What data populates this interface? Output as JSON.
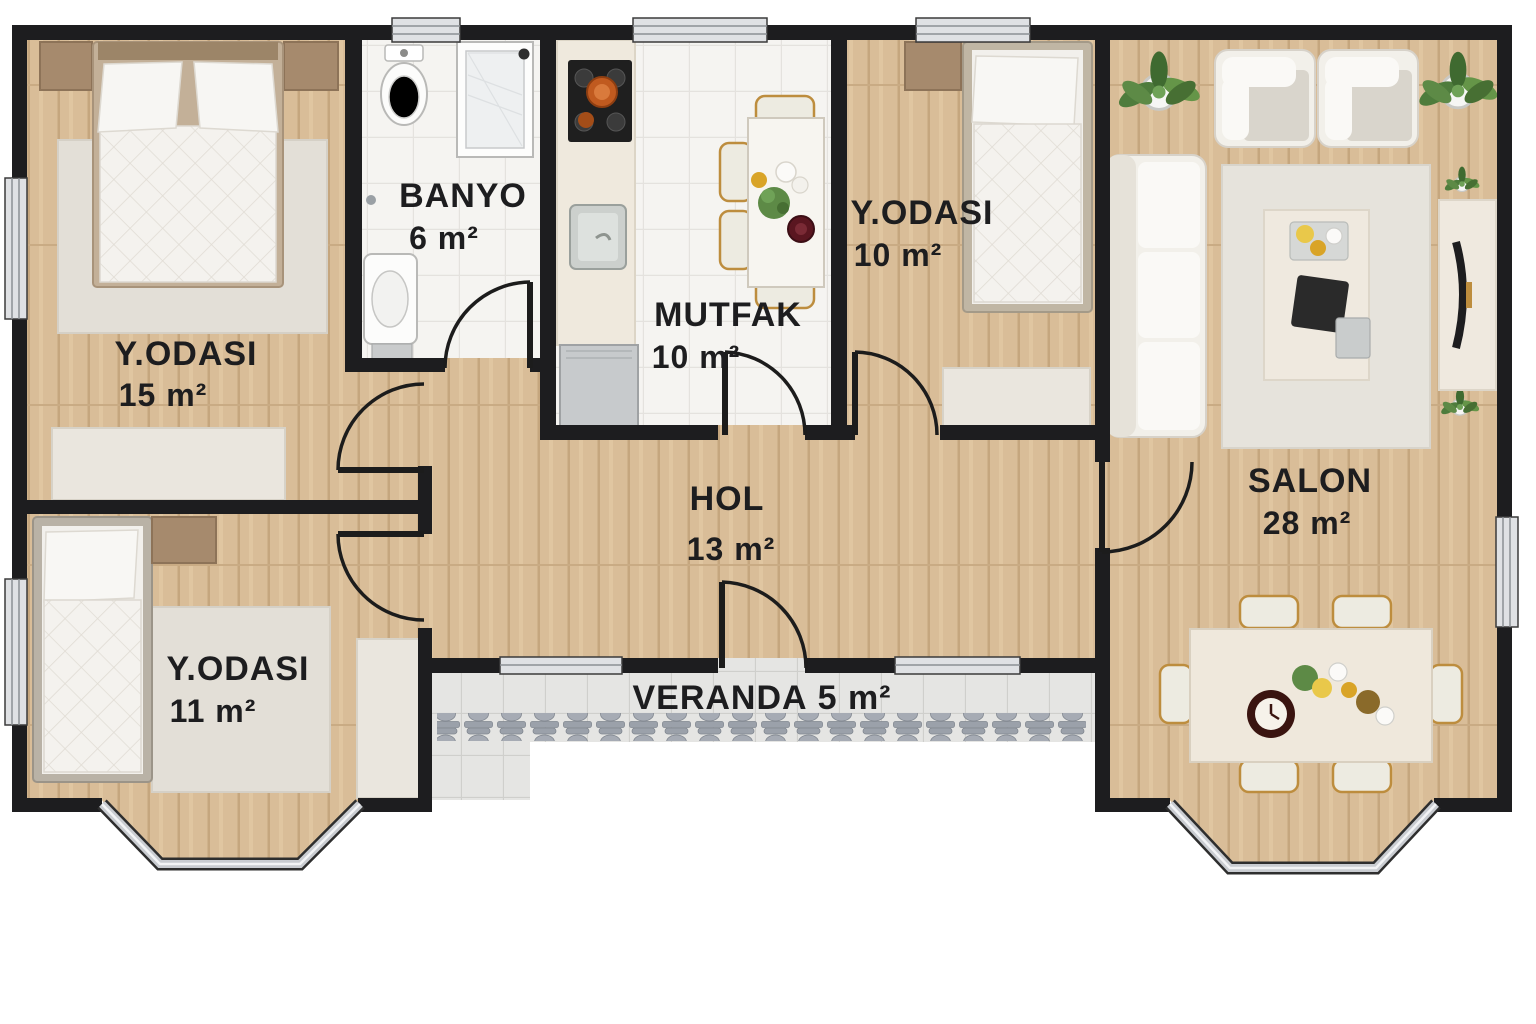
{
  "rooms": [
    {
      "id": "bedroom-15",
      "name": "Y.ODASI",
      "area": "15 m²"
    },
    {
      "id": "bathroom",
      "name": "BANYO",
      "area": "6 m²"
    },
    {
      "id": "kitchen",
      "name": "MUTFAK",
      "area": "10 m²"
    },
    {
      "id": "bedroom-10",
      "name": "Y.ODASI",
      "area": "10 m²"
    },
    {
      "id": "living-room",
      "name": "SALON",
      "area": "28 m²"
    },
    {
      "id": "hall",
      "name": "HOL",
      "area": "13 m²"
    },
    {
      "id": "bedroom-11",
      "name": "Y.ODASI",
      "area": "11 m²"
    },
    {
      "id": "veranda",
      "name": "VERANDA",
      "area": "5 m²"
    }
  ],
  "veranda": {
    "baluster_count": 20
  },
  "colors": {
    "wall": "#1d1d1f",
    "wood_floor": "#d9bd98",
    "bath_tile": "#f5f4f1",
    "veranda_tile": "#e5e5e3",
    "rug": "#e3dfd7",
    "white_furniture": "#f2f0ea",
    "wood_furniture": "#a68a6d",
    "plant_green": "#527d3c",
    "gold_trim": "#bd8d3e",
    "stove_black": "#1f1f1f",
    "pot_orange": "#c05a1f",
    "window_gray": "#dfe1e4"
  }
}
